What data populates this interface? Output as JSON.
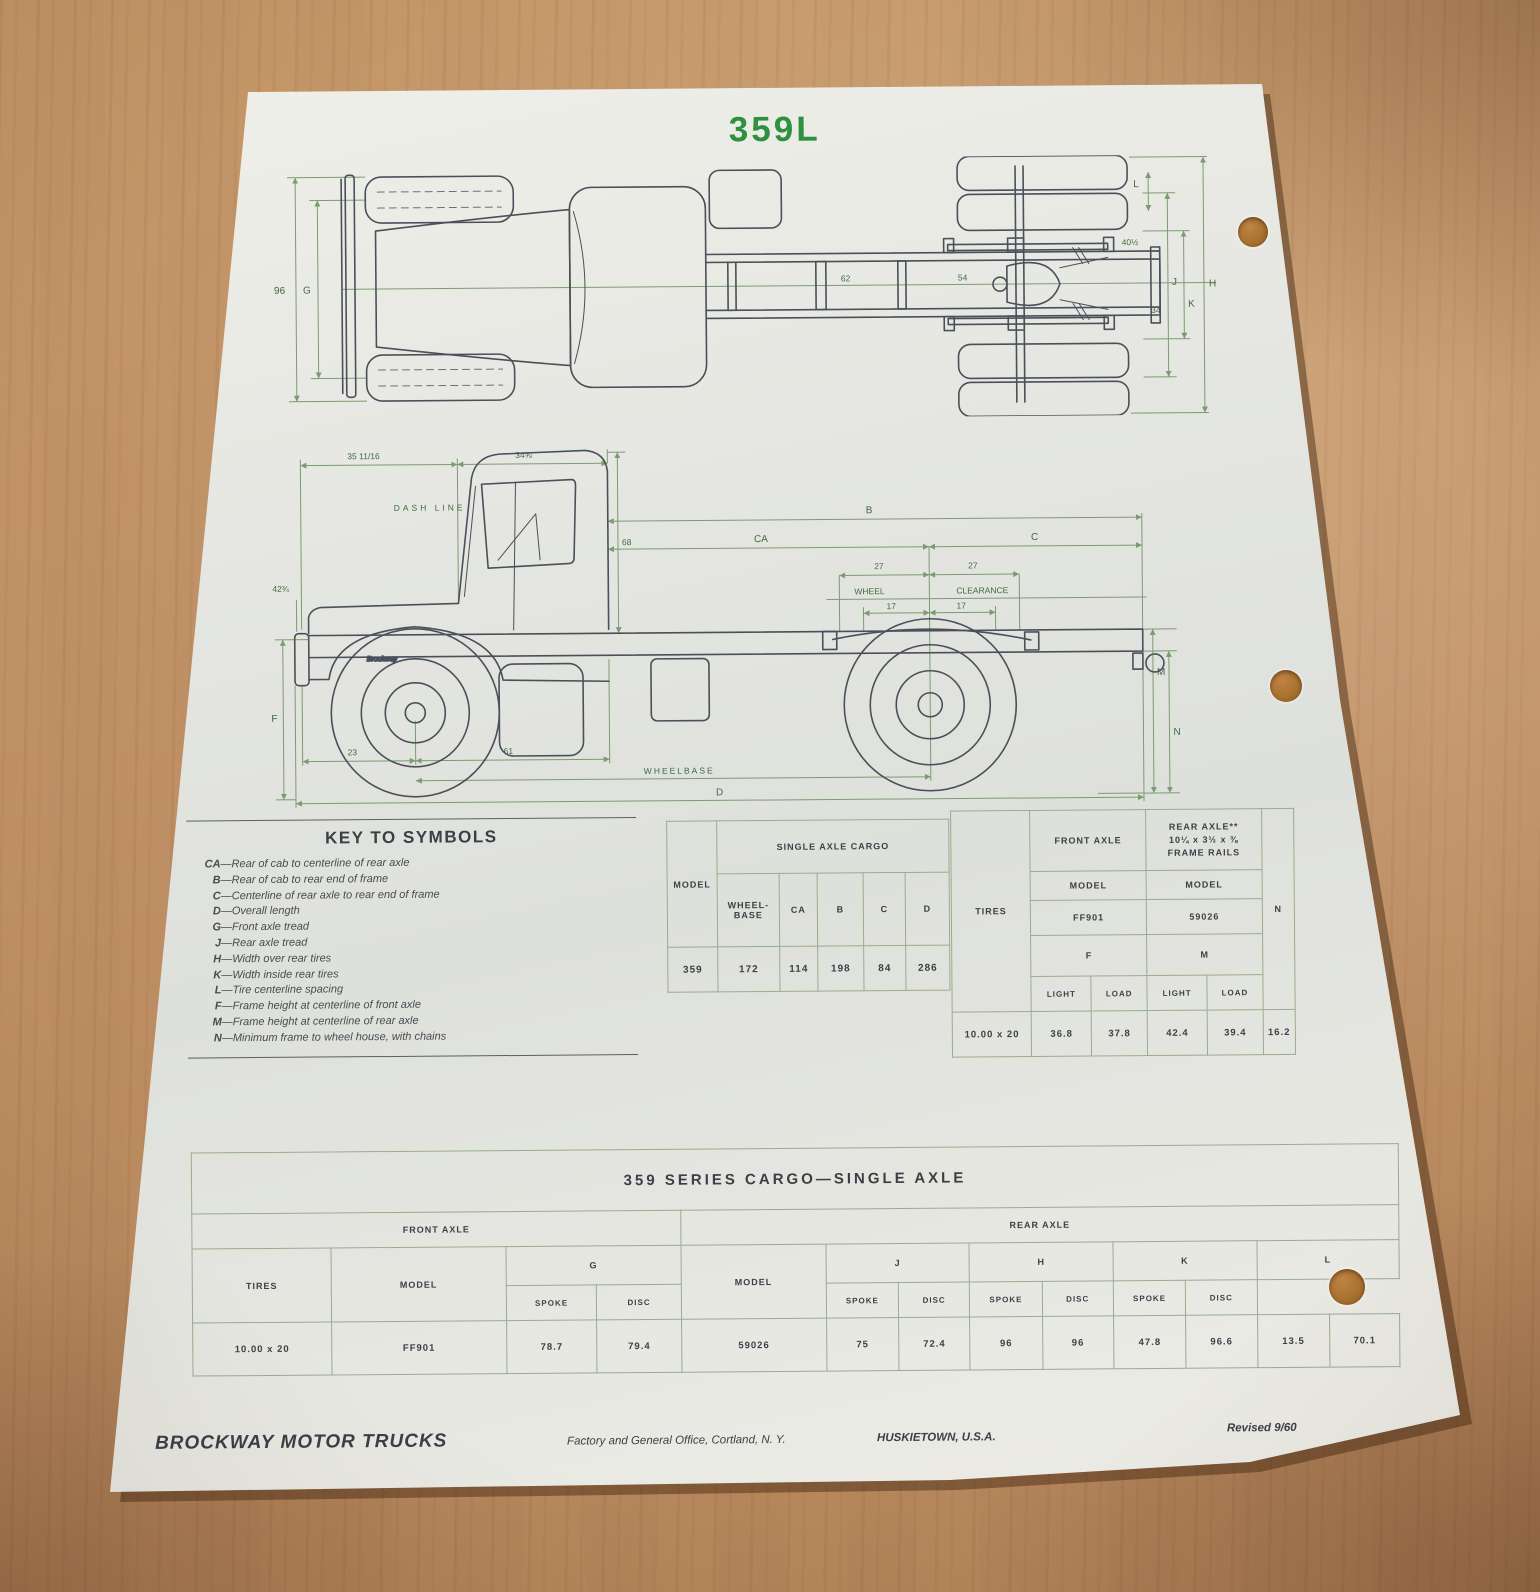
{
  "page_title": "359L",
  "accent_green": "#2f9140",
  "table_border_green": "#97ae8c",
  "keys": {
    "heading": "KEY TO SYMBOLS",
    "items": [
      {
        "sym": "CA",
        "desc": "—Rear of cab to centerline of rear axle"
      },
      {
        "sym": "B",
        "desc": "—Rear of cab to rear end of frame"
      },
      {
        "sym": "C",
        "desc": "—Centerline of rear axle to rear end of frame"
      },
      {
        "sym": "D",
        "desc": "—Overall length"
      },
      {
        "sym": "G",
        "desc": "—Front axle tread"
      },
      {
        "sym": "J",
        "desc": "—Rear axle tread"
      },
      {
        "sym": "H",
        "desc": "—Width over rear tires"
      },
      {
        "sym": "K",
        "desc": "—Width inside rear tires"
      },
      {
        "sym": "L",
        "desc": "—Tire centerline spacing"
      },
      {
        "sym": "F",
        "desc": "—Frame height at centerline of front  axle"
      },
      {
        "sym": "M",
        "desc": "—Frame height at centerline of rear axle"
      },
      {
        "sym": "N",
        "desc": "—Minimum frame to wheel house, with chains"
      }
    ]
  },
  "tables": {
    "cargo": {
      "model_header": "MODEL",
      "span_header": "SINGLE AXLE CARGO",
      "wheelbase_header": "WHEEL-BASE",
      "cols": [
        "CA",
        "B",
        "C",
        "D"
      ],
      "row": [
        "359",
        "172",
        "114",
        "198",
        "84",
        "286"
      ]
    },
    "heights": {
      "tires_header": "TIRES",
      "front_header": "FRONT AXLE",
      "rear_header_line1": "REAR AXLE**",
      "rear_header_line2": "10¼ x 3½ x ⅜",
      "rear_header_line3": "FRAME RAILS",
      "model_header": "MODEL",
      "front_model": "FF901",
      "rear_model": "59026",
      "f": "F",
      "m": "M",
      "n": "N",
      "light": "LIGHT",
      "load": "LOAD",
      "row": [
        "10.00 x 20",
        "36.8",
        "37.8",
        "42.4",
        "39.4",
        "16.2"
      ]
    },
    "series": {
      "title": "359 SERIES CARGO—SINGLE AXLE",
      "front_header": "FRONT AXLE",
      "rear_header": "REAR AXLE",
      "tires_header": "TIRES",
      "model_header": "MODEL",
      "g": "G",
      "j": "J",
      "h": "H",
      "k": "K",
      "l": "L",
      "spoke": "SPOKE",
      "disc": "DISC",
      "row": [
        "10.00 x 20",
        "FF901",
        "78.7",
        "79.4",
        "59026",
        "75",
        "72.4",
        "96",
        "96",
        "47.8",
        "96.6",
        "13.5",
        "70.1"
      ]
    }
  },
  "top_view": {
    "width_outer": "96",
    "g": "G",
    "mid1": "62",
    "mid2": "54",
    "r_upper": "40½",
    "r_mid": "34",
    "j": "J",
    "k": "K",
    "h": "H",
    "l": "L"
  },
  "side_view": {
    "top_left_dim": "35 11/16",
    "top_right_dim": "34⅝",
    "dash_line": "DASH LINE",
    "hood_dim": "42¾",
    "cab_height": "68",
    "b": "B",
    "ca": "CA",
    "c": "C",
    "wc27a": "27",
    "wc27b": "27",
    "wheel": "WHEEL",
    "clearance": "CLEARANCE",
    "wc17a": "17",
    "wc17b": "17",
    "m": "M",
    "n": "N",
    "f": "F",
    "front_overhang": "23",
    "axle_to_cab": "61",
    "wheelbase": "WHEELBASE",
    "d": "D",
    "brand": "Brockway"
  },
  "footer": {
    "brand": "BROCKWAY MOTOR TRUCKS",
    "address": "Factory and General Office, Cortland, N. Y.",
    "city": "HUSKIETOWN, U.S.A.",
    "revised": "Revised 9/60"
  }
}
